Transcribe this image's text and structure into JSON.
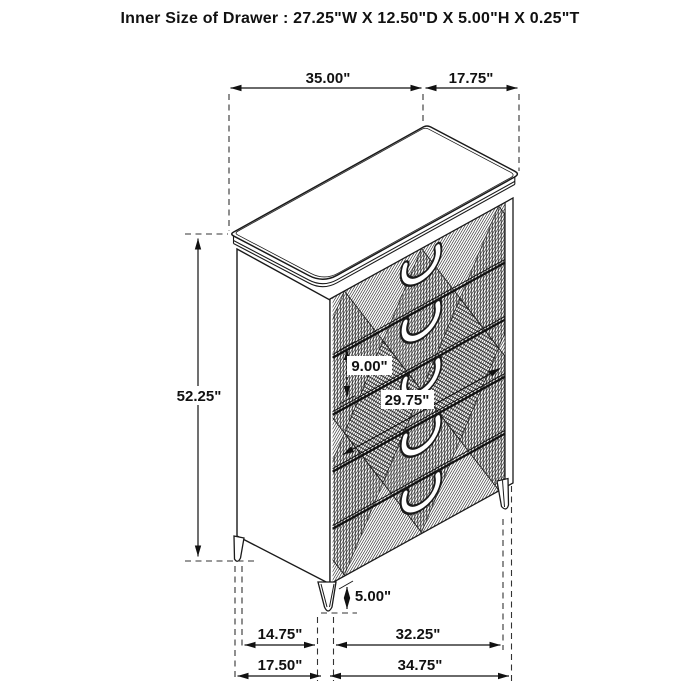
{
  "title": "Inner Size of Drawer : 27.25\"W X 12.50\"D X 5.00\"H X 0.25\"T",
  "dimensions": {
    "top_width": "35.00\"",
    "top_depth": "17.75\"",
    "overall_height": "52.25\"",
    "drawer_front_height": "9.00\"",
    "front_width": "29.75\"",
    "leg_height": "5.00\"",
    "bottom_inner_depth": "14.75\"",
    "bottom_inner_width": "32.25\"",
    "bottom_depth": "17.50\"",
    "bottom_width": "34.75\""
  },
  "colors": {
    "line": "#1a1a1a",
    "text": "#111111",
    "background": "#ffffff"
  }
}
